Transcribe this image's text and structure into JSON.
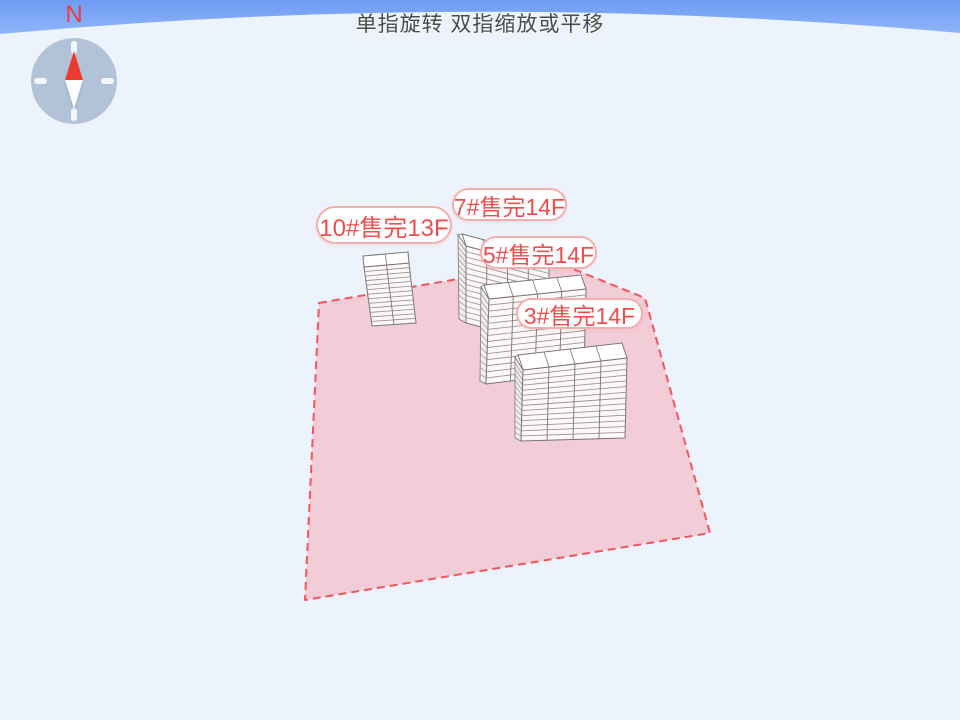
{
  "app": {
    "hint_text": "单指旋转 双指缩放或平移",
    "compass": {
      "north_label": "N"
    },
    "colors": {
      "sky_top": "#6d9af3",
      "sky_bottom": "#8fb6fa",
      "ground": "#edf3fc",
      "parcel_fill": "#f2cdd7",
      "parcel_border": "#f1575a",
      "bubble_border": "#f5aeae",
      "bubble_text": "#ef4d4d",
      "building_fill": "#fdf8f8",
      "building_side_fill": "#f3edee",
      "building_roof_fill": "#ffffff",
      "building_line": "#9b9494",
      "building_outline": "#7b7474",
      "compass_face": "#b3c3d7",
      "needle_north": "#ee3b30",
      "needle_south": "#fbfcfe"
    }
  },
  "buildings": [
    {
      "id": "10",
      "label": "10#售完13F",
      "number": "10#",
      "status": "售完",
      "floors": 13
    },
    {
      "id": "7",
      "label": "7#售完14F",
      "number": "7#",
      "status": "售完",
      "floors": 14
    },
    {
      "id": "5",
      "label": "5#售完14F",
      "number": "5#",
      "status": "售完",
      "floors": 14
    },
    {
      "id": "3",
      "label": "3#售完14F",
      "number": "3#",
      "status": "售完",
      "floors": 14
    }
  ]
}
